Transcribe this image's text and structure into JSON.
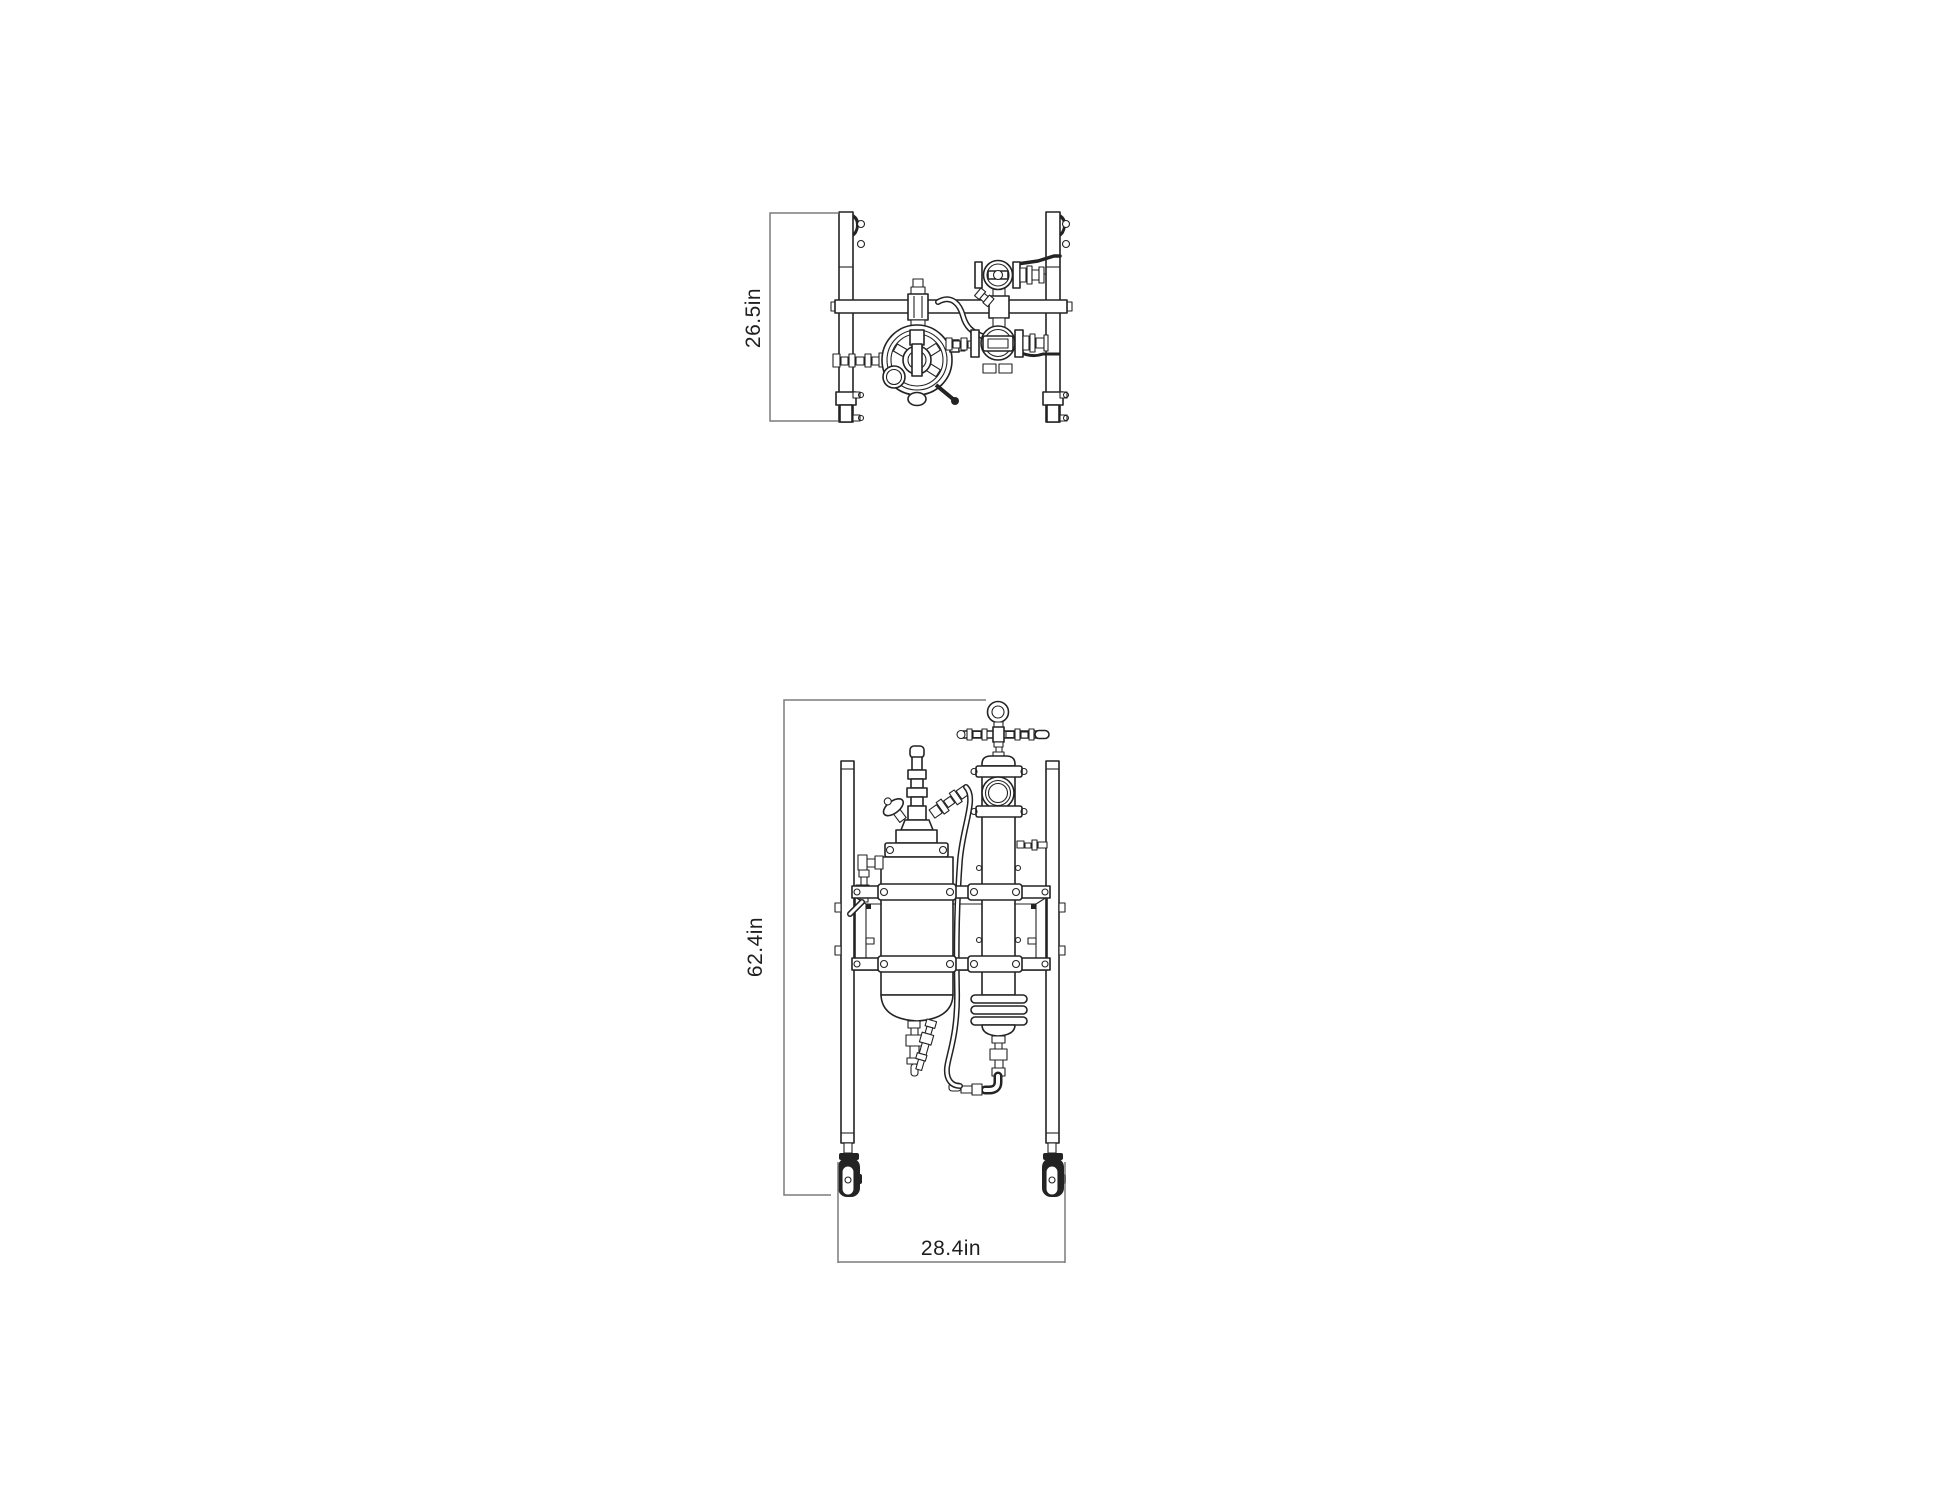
{
  "page": {
    "background_color": "#ffffff",
    "line_color": "#232323",
    "dimension_line_color": "#7b7b7b"
  },
  "drawing": {
    "dimensions": {
      "top_view_depth": "26.5in",
      "front_view_height": "62.4in",
      "front_view_width": "28.4in"
    }
  }
}
